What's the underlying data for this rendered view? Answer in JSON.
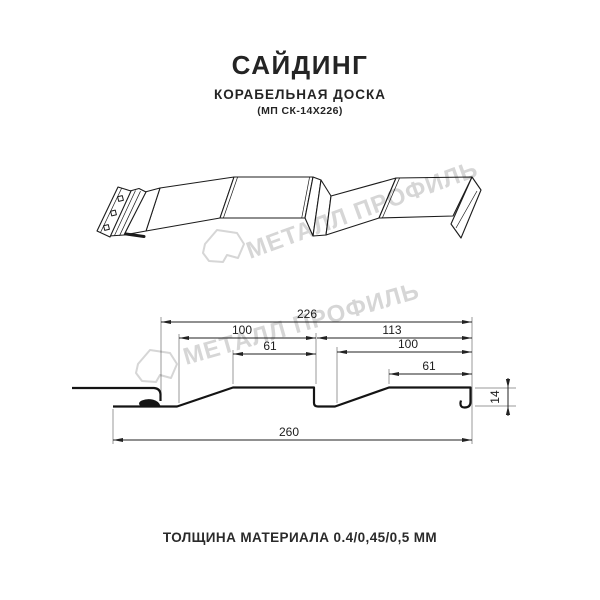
{
  "header": {
    "title": "САЙДИНГ",
    "subtitle": "КОРАБЕЛЬНАЯ ДОСКА",
    "model": "(МП СК-14Х226)"
  },
  "footer": {
    "text": "ТОЛЩИНА МАТЕРИАЛА 0.4/0,45/0,5 ММ"
  },
  "watermark": {
    "text": "МЕТАЛЛ ПРОФИЛЬ",
    "color": "#d6d6d6"
  },
  "colors": {
    "background": "#ffffff",
    "profile_line": "#1c1c1c",
    "dimension_line": "#222222",
    "extension_line": "#777777"
  },
  "drawing": {
    "type": "technical-section",
    "units": "mm",
    "dimensions": {
      "useful_width": "226",
      "board1_width": "100",
      "board1_face": "61",
      "board2_width": "113",
      "board2_inner": "100",
      "board2_face": "61",
      "total_width": "260",
      "profile_height": "14"
    }
  }
}
